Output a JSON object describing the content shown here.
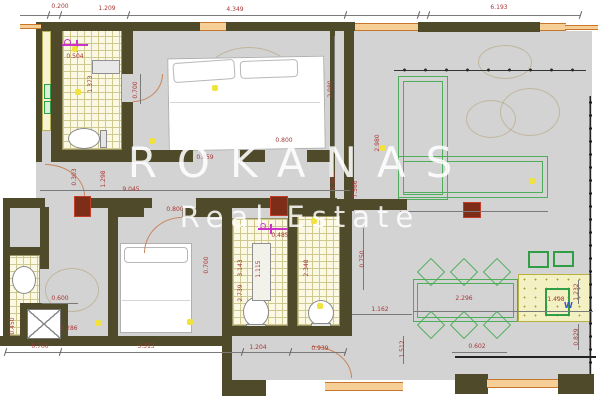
{
  "watermark": {
    "line1": "ROKANAS",
    "line2": "Real Estate"
  },
  "kitchenette": {
    "washer_label": "W"
  },
  "colors": {
    "wall": "#4f4a2a",
    "floor": "#d3d3d3",
    "tilebg": "#fbf9e4",
    "tileline": "#cfc98f",
    "winfill": "#f6cf96",
    "winline": "#c8762c",
    "dimred": "#a83636",
    "green": "#4fae5c",
    "green2": "#2f9e44",
    "colred": "#7e2d18",
    "magenta": "#cc33cc",
    "lightyellow": "#f2e23d"
  },
  "dimensions": [
    {
      "text": "0.200",
      "x": 60,
      "y": 7,
      "v": false
    },
    {
      "text": "1.209",
      "x": 107,
      "y": 9,
      "v": false
    },
    {
      "text": "4.349",
      "x": 235,
      "y": 10,
      "v": false
    },
    {
      "text": "6.193",
      "x": 499,
      "y": 8,
      "v": false
    },
    {
      "text": "0.504",
      "x": 75,
      "y": 57,
      "v": false
    },
    {
      "text": "1.373",
      "x": 91,
      "y": 84,
      "v": true
    },
    {
      "text": "0.700",
      "x": 136,
      "y": 90,
      "v": true
    },
    {
      "text": "2.980",
      "x": 331,
      "y": 89,
      "v": true
    },
    {
      "text": "2.980",
      "x": 378,
      "y": 143,
      "v": true
    },
    {
      "text": "0.859",
      "x": 205,
      "y": 158,
      "v": false
    },
    {
      "text": "0.800",
      "x": 284,
      "y": 141,
      "v": false
    },
    {
      "text": "0.900",
      "x": 334,
      "y": 181,
      "v": true
    },
    {
      "text": "7.566",
      "x": 356,
      "y": 189,
      "v": true
    },
    {
      "text": "9.045",
      "x": 131,
      "y": 190,
      "v": false
    },
    {
      "text": "0.303",
      "x": 75,
      "y": 177,
      "v": true
    },
    {
      "text": "1.298",
      "x": 104,
      "y": 179,
      "v": true
    },
    {
      "text": "0.800",
      "x": 175,
      "y": 210,
      "v": false
    },
    {
      "text": "0.485",
      "x": 280,
      "y": 236,
      "v": false
    },
    {
      "text": "0.700",
      "x": 207,
      "y": 265,
      "v": true
    },
    {
      "text": "3.143",
      "x": 241,
      "y": 268,
      "v": true
    },
    {
      "text": "1.115",
      "x": 259,
      "y": 269,
      "v": true
    },
    {
      "text": "2.348",
      "x": 307,
      "y": 268,
      "v": true
    },
    {
      "text": "2.739",
      "x": 241,
      "y": 293,
      "v": true
    },
    {
      "text": "0.750",
      "x": 363,
      "y": 259,
      "v": true
    },
    {
      "text": "1.162",
      "x": 380,
      "y": 310,
      "v": false
    },
    {
      "text": "2.296",
      "x": 464,
      "y": 299,
      "v": false
    },
    {
      "text": "1.498",
      "x": 556,
      "y": 300,
      "v": false
    },
    {
      "text": "1.232",
      "x": 577,
      "y": 292,
      "v": true
    },
    {
      "text": "0.829",
      "x": 577,
      "y": 337,
      "v": true
    },
    {
      "text": "1.512",
      "x": 403,
      "y": 349,
      "v": true
    },
    {
      "text": "0.602",
      "x": 477,
      "y": 347,
      "v": false
    },
    {
      "text": "0.700",
      "x": 40,
      "y": 347,
      "v": false
    },
    {
      "text": "3.313",
      "x": 146,
      "y": 347,
      "v": false
    },
    {
      "text": "1.204",
      "x": 258,
      "y": 348,
      "v": false
    },
    {
      "text": "0.939",
      "x": 320,
      "y": 349,
      "v": false
    },
    {
      "text": "0.600",
      "x": 60,
      "y": 299,
      "v": false
    },
    {
      "text": "0.450",
      "x": 13,
      "y": 326,
      "v": true
    },
    {
      "text": "0.286",
      "x": 69,
      "y": 329,
      "v": false
    }
  ],
  "lights": [
    [
      75,
      49
    ],
    [
      78,
      92
    ],
    [
      215,
      88
    ],
    [
      152,
      141
    ],
    [
      383,
      148
    ],
    [
      532,
      181
    ],
    [
      314,
      221
    ],
    [
      98,
      323
    ],
    [
      190,
      322
    ],
    [
      320,
      306
    ]
  ],
  "chairs": [
    [
      431,
      272
    ],
    [
      464,
      272
    ],
    [
      497,
      272
    ],
    [
      431,
      325
    ],
    [
      464,
      325
    ],
    [
      497,
      325
    ]
  ]
}
